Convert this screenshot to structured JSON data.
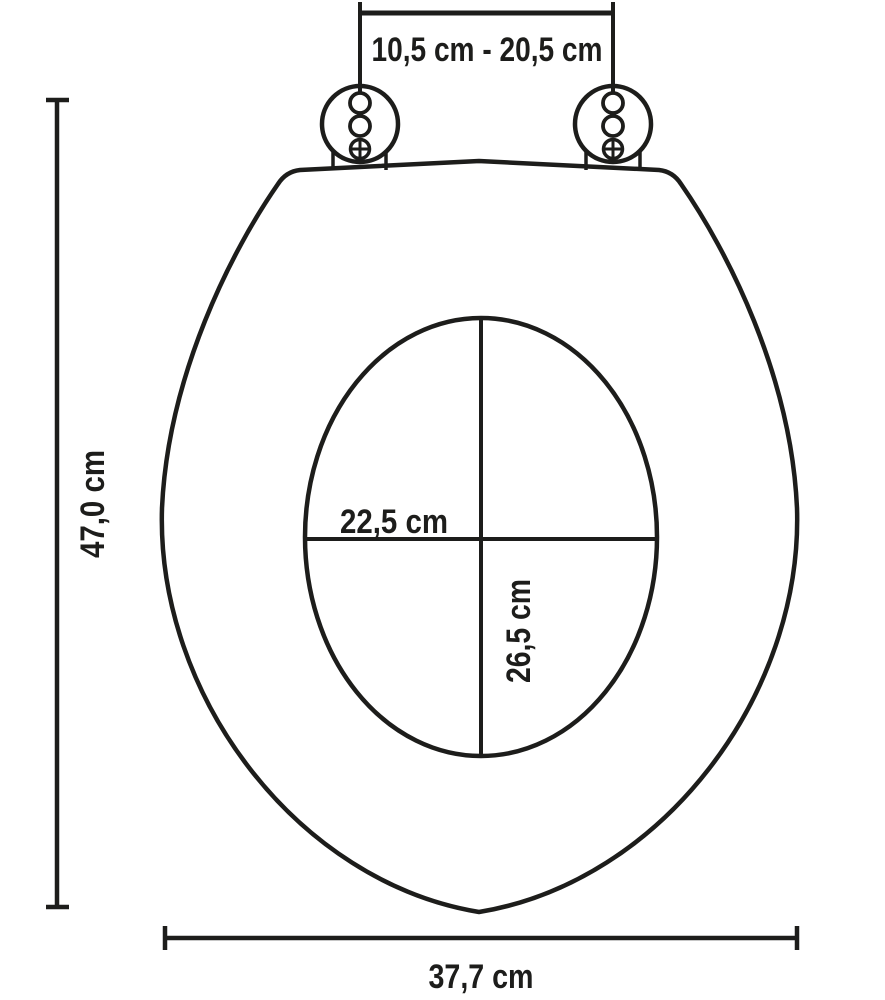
{
  "diagram": {
    "subject": "toilet-seat-top-view-dimension-drawing",
    "background_color": "#ffffff",
    "line_color": "#1d1d1b",
    "dimensions": {
      "hinge_spacing": "10,5 cm - 20,5 cm",
      "overall_length": "47,0 cm",
      "inner_width": "22,5 cm",
      "inner_length": "26,5 cm",
      "overall_width": "37,7 cm"
    }
  }
}
